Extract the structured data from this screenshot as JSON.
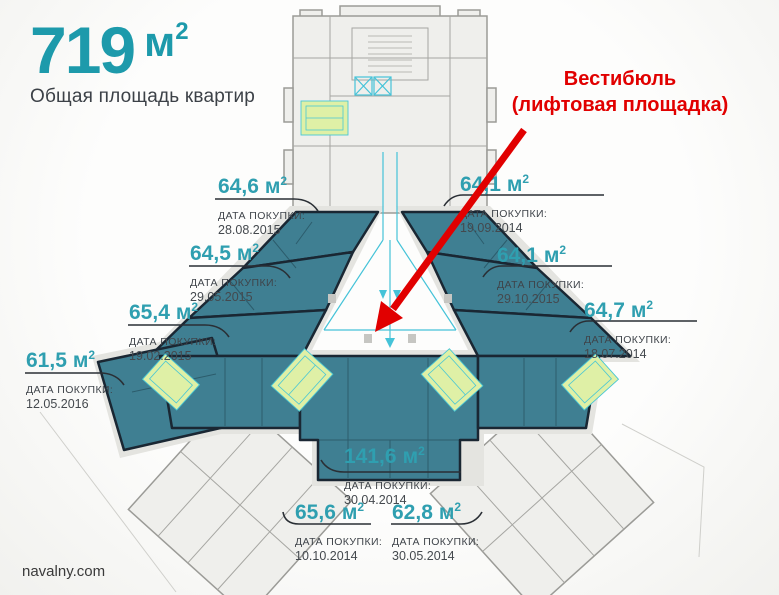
{
  "header": {
    "total_area": "719",
    "subtitle": "Общая площадь квартир"
  },
  "unit": {
    "symbol": "м",
    "sup": "2"
  },
  "annotation": {
    "line1": "Вестибюль",
    "line2": "(лифтовая площадка)"
  },
  "purchase_caption": "ДАТА ПОКУПКИ:",
  "apartments": [
    {
      "area": "64,6",
      "date": "28.08.2015"
    },
    {
      "area": "64,1",
      "date": "19.09.2014"
    },
    {
      "area": "64,5",
      "date": "29.05.2015"
    },
    {
      "area": "64,1",
      "date": "29.10.2015"
    },
    {
      "area": "65,4",
      "date": "19.02.2015"
    },
    {
      "area": "64,7",
      "date": "18.07.2014"
    },
    {
      "area": "61,5",
      "date": "12.05.2016"
    },
    {
      "area": "141,6",
      "date": "30.04.2014"
    },
    {
      "area": "65,6",
      "date": "10.10.2014"
    },
    {
      "area": "62,8",
      "date": "30.05.2014"
    }
  ],
  "footer": {
    "site": "navalny.com"
  },
  "colors": {
    "accent_teal": "#1d9aab",
    "label_teal": "#2f9fb0",
    "apartment_fill": "#3f7f92",
    "apartment_outline": "#1a2733",
    "stair_highlight": "#dff0a6",
    "elevator_cyan": "#45c3d8",
    "annotation_red": "#e10000",
    "text_dark": "#3f444a",
    "plan_gray": "#9b9b97"
  }
}
